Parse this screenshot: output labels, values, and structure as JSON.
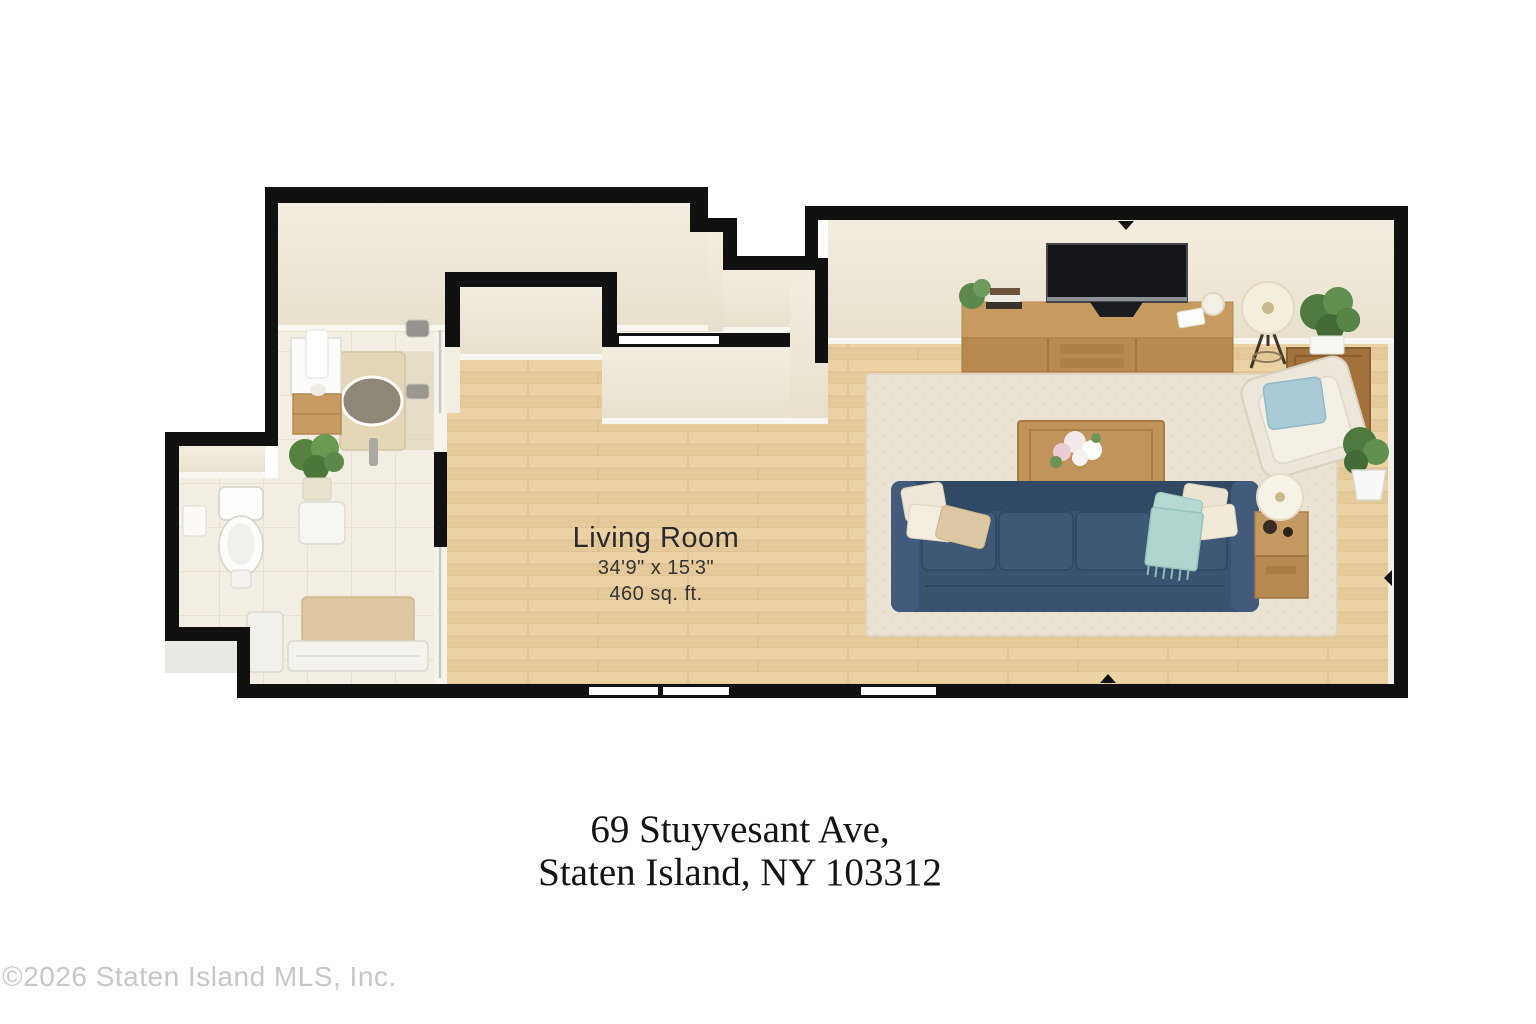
{
  "labels": {
    "room_name": "Living Room",
    "room_dimensions": "34'9\" x 15'3\"",
    "room_area": "460 sq. ft.",
    "address_line1": "69 Stuyvesant Ave,",
    "address_line2": "Staten Island, NY 103312",
    "copyright": "©2026 Staten Island MLS, Inc."
  },
  "colors": {
    "wall": "#111111",
    "wood_floor": "#e8cfa0",
    "tile_floor": "#f3eee3",
    "wall_face": "#efe8da",
    "sofa_blue": "#3a536f",
    "rug": "#eae2d2",
    "teal_throw": "#b7d9d3",
    "wood_furniture": "#c0945a",
    "plant_green": "#5d8a4a"
  },
  "furniture": {
    "living_room": [
      "tv",
      "tv-console",
      "books",
      "candle",
      "floor-lamp",
      "potted-plant-large",
      "corner-cabinet",
      "armchair",
      "accent-pillow",
      "side-table",
      "table-lamp",
      "sofa",
      "throw-blanket",
      "coffee-table",
      "flowers",
      "area-rug",
      "potted-plant-small"
    ],
    "bathroom": [
      "vanity",
      "towel",
      "shower",
      "shower-drain",
      "shower-fixtures",
      "toilet",
      "toilet-paper-holder",
      "plant",
      "stool",
      "bath-mat",
      "bench",
      "chair"
    ]
  }
}
